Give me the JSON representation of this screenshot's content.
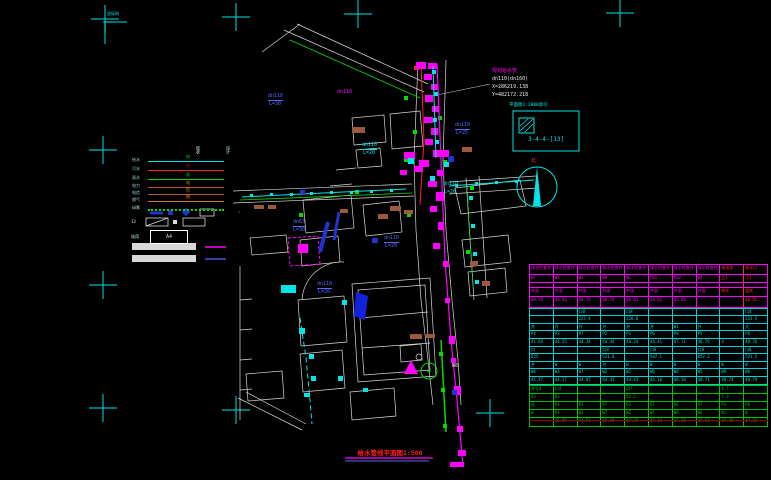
{
  "title": {
    "text": "给水管线平面图1:500"
  },
  "index_box": {
    "title": "平面图1:2000索引",
    "code": "3-4-4-[13]"
  },
  "north": {
    "label": "北"
  },
  "frame": {
    "corner_note": "坐标网"
  },
  "legend": {
    "col_headers": [
      "现状",
      "设计"
    ],
    "items": [
      {
        "label": "给水",
        "color": "#00e5e5",
        "style": "solid",
        "tick": "给",
        "tick_color": "#00dd00"
      },
      {
        "label": "污水",
        "color": "#ff2020",
        "style": "solid",
        "tick": "污",
        "tick_color": "#ff2020"
      },
      {
        "label": "雨水",
        "color": "#00dd00",
        "style": "solid",
        "tick": "雨",
        "tick_color": "#00dd00"
      },
      {
        "label": "电力",
        "color": "#aa5a3c",
        "style": "solid",
        "tick": "电",
        "tick_color": "#ff8000"
      },
      {
        "label": "电信",
        "color": "#aa5a3c",
        "style": "solid",
        "tick": "信",
        "tick_color": "#ff8000"
      },
      {
        "label": "燃气",
        "color": "#cc7a30",
        "style": "solid",
        "tick": "燃",
        "tick_color": "#ff8000"
      },
      {
        "label": "绿篱",
        "color": "#00dd00",
        "style": "dotted",
        "tick": "",
        "tick_color": "#00dd00"
      }
    ],
    "angle_symbol": "∠",
    "sheet_num": "13",
    "paper": {
      "prefix": "选用",
      "label": "A4"
    }
  },
  "map": {
    "labels": [
      {
        "text": "规划给水管",
        "x": 492,
        "y": 69,
        "c": "#ff00ff"
      },
      {
        "text": "dn110(dn160)",
        "x": 492,
        "y": 77,
        "c": "#e8e8e8"
      },
      {
        "text": "X=286219.138",
        "x": 492,
        "y": 85,
        "c": "#e8e8e8"
      },
      {
        "text": "Y=482172.218",
        "x": 492,
        "y": 93,
        "c": "#e8e8e8"
      },
      {
        "text": "dn110",
        "x": 362,
        "y": 143,
        "c": "#00e5e5",
        "u": true
      },
      {
        "text": "L=20",
        "x": 363,
        "y": 151,
        "c": "#00e5e5"
      },
      {
        "text": "dn110",
        "x": 455,
        "y": 123,
        "c": "#5566ff",
        "u": true
      },
      {
        "text": "L=25",
        "x": 456,
        "y": 131,
        "c": "#5566ff"
      },
      {
        "text": "dn110",
        "x": 384,
        "y": 236,
        "c": "#5566ff",
        "u": true
      },
      {
        "text": "L=20",
        "x": 385,
        "y": 244,
        "c": "#5566ff"
      },
      {
        "text": "dn63",
        "x": 293,
        "y": 220,
        "c": "#5566ff",
        "u": true
      },
      {
        "text": "L=30",
        "x": 293,
        "y": 228,
        "c": "#5566ff"
      },
      {
        "text": "dn110",
        "x": 317,
        "y": 282,
        "c": "#5566ff",
        "u": true
      },
      {
        "text": "L=26",
        "x": 318,
        "y": 290,
        "c": "#5566ff"
      },
      {
        "text": "dn110",
        "x": 268,
        "y": 94,
        "c": "#5566ff",
        "u": true
      },
      {
        "text": "L=30",
        "x": 269,
        "y": 102,
        "c": "#5566ff"
      },
      {
        "text": "dn110",
        "x": 337,
        "y": 90,
        "c": "#ff00ff"
      },
      {
        "text": "W8",
        "x": 452,
        "y": 364,
        "c": "#e8e8e8"
      },
      {
        "text": "dn110",
        "x": 443,
        "y": 182,
        "c": "#00e5e5"
      },
      {
        "text": "L=20",
        "x": 444,
        "y": 190,
        "c": "#00e5e5"
      }
    ]
  },
  "table": {
    "sections": [
      {
        "color": "#ff00ff",
        "red_cols": [
          8,
          9
        ],
        "row_heights": [
          10,
          8,
          5,
          9,
          10
        ],
        "rows": [
          [
            "排水检查井",
            "排水检查井",
            "排水检查井",
            "排水检查井",
            "排水检查井",
            "排水检查井",
            "排水检查井",
            "排水检查井",
            "接现状",
            "雨水口"
          ],
          [
            "W7",
            "W5",
            "W2",
            "W9",
            "W1",
            "P61",
            "P62",
            "W4",
            "品1",
            "污1"
          ],
          [
            "",
            "",
            "",
            "",
            "",
            "",
            "",
            "",
            "",
            ""
          ],
          [
            "井面",
            "井面",
            "井面",
            "井面",
            "井面",
            "井面",
            "井面",
            "井面",
            "原状",
            "管底"
          ],
          [
            "48.74",
            "48.93",
            "48.73",
            "48.79",
            "48.81",
            "44.82",
            "43.84",
            "",
            "",
            "48.85"
          ]
        ]
      },
      {
        "color": "#00d5d5",
        "red_cols": [],
        "row_heights": [
          7,
          8,
          7,
          8,
          8,
          7,
          8,
          7,
          8,
          7
        ],
        "rows": [
          [
            "",
            "",
            "口8",
            "",
            "口8",
            "",
            "",
            "",
            "",
            "口8"
          ],
          [
            "",
            "",
            "225.4",
            "",
            "228.6",
            "",
            "",
            "",
            "",
            "223.5"
          ],
          [
            "井",
            "丹",
            "井",
            "井",
            "井",
            "井",
            "W1",
            "井",
            "",
            "大"
          ],
          [
            "P4",
            "P3",
            "P7",
            "P2",
            "P1",
            "P6",
            "P8",
            "P5",
            "",
            "P6"
          ],
          [
            "41.64",
            "44.55",
            "44.34",
            "44.44",
            "44.34",
            "44.41",
            "47.11",
            "48.79",
            "4",
            "48.76"
          ],
          [
            "口",
            "",
            "",
            "口8",
            "",
            "口8",
            "",
            "口8",
            "",
            "口8"
          ],
          [
            "D25",
            "",
            "",
            "531.0",
            "",
            "587.1",
            "",
            "852.2",
            "",
            "521.5"
          ],
          [
            "井",
            "W",
            "W",
            "井",
            "W",
            "W",
            "W",
            "W",
            "W",
            "W"
          ],
          [
            "W4",
            "W3",
            "W7",
            "W2",
            "W1",
            "W6",
            "W8",
            "W5",
            "W9",
            "W6"
          ],
          [
            "41.47",
            "44.57",
            "44.07",
            "44.43",
            "44.43",
            "44.10",
            "48.10",
            "48.71",
            "48.74",
            "48.79"
          ]
        ]
      },
      {
        "color": "#00c400",
        "red_cols": [],
        "row_heights": [
          8,
          8,
          8,
          8,
          8
        ],
        "rows": [
          [
            "井号4",
            "口4",
            "",
            "",
            "口7",
            "",
            "",
            "",
            "4.7",
            ""
          ],
          [
            "45",
            "D3",
            "",
            "",
            "52.2",
            "",
            "",
            "",
            "7.3",
            ""
          ],
          [
            "检",
            "P4",
            "P3",
            "P7",
            "P2",
            "P1",
            "P6",
            "P7",
            "P1",
            "P6"
          ],
          [
            "W",
            "P4",
            "W3",
            "W7",
            "W2",
            "W1",
            "W6",
            "W6",
            "W1",
            "W"
          ],
          [
            "",
            "46.89",
            "44.91",
            "47.28",
            "47.39",
            "47.24",
            "47.34",
            "47.52",
            "47.48",
            "47.83"
          ]
        ]
      }
    ]
  }
}
